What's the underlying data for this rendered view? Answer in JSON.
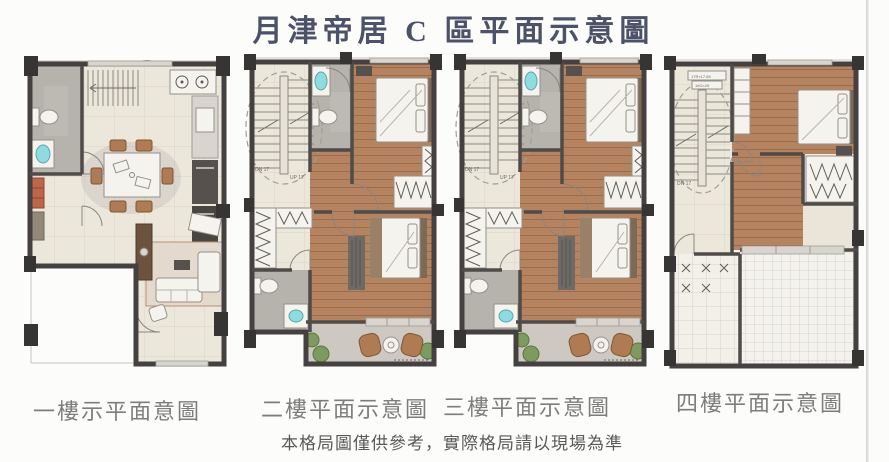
{
  "page": {
    "title": "月津帝居 C 區平面示意圖",
    "caption": "本格局圖僅供參考，實際格局請以現場為準"
  },
  "plans": [
    {
      "id": "floor-1",
      "label": "一樓示平面意圖",
      "features": [
        "entry porch",
        "living room",
        "dining area",
        "kitchen",
        "bathroom",
        "staircase"
      ]
    },
    {
      "id": "floor-2",
      "label": "二樓平面示意圖",
      "features": [
        "staircase",
        "bathroom",
        "bedroom",
        "walk-in closet",
        "second bathroom",
        "master bedroom",
        "balcony"
      ]
    },
    {
      "id": "floor-3",
      "label": "三樓平面示意圖",
      "features": [
        "staircase",
        "bathroom",
        "bedroom",
        "walk-in closet",
        "second bathroom",
        "master bedroom",
        "balcony"
      ]
    },
    {
      "id": "floor-4",
      "label": "四樓平面示意圖",
      "features": [
        "staircase",
        "bedroom",
        "storage room",
        "roof terrace"
      ]
    }
  ],
  "annotations": {
    "stair_down": "DN 17",
    "stair_up": "UP 17",
    "stair_riser": "17R×17.65",
    "stair_tread": "16G×25"
  },
  "colors": {
    "title_text": "#4b5269",
    "label_text": "#7d7d7d",
    "caption_text": "#595959",
    "wall": "#454140",
    "wood_floor": "#b5835f",
    "tile_floor": "#ece7db",
    "bathroom_floor": "#b6b2ac",
    "balcony_floor": "#cdc9c2",
    "sink_accent": "#8edbe0",
    "plant_green": "#7d9b5e",
    "chair_brown": "#b07a52"
  }
}
